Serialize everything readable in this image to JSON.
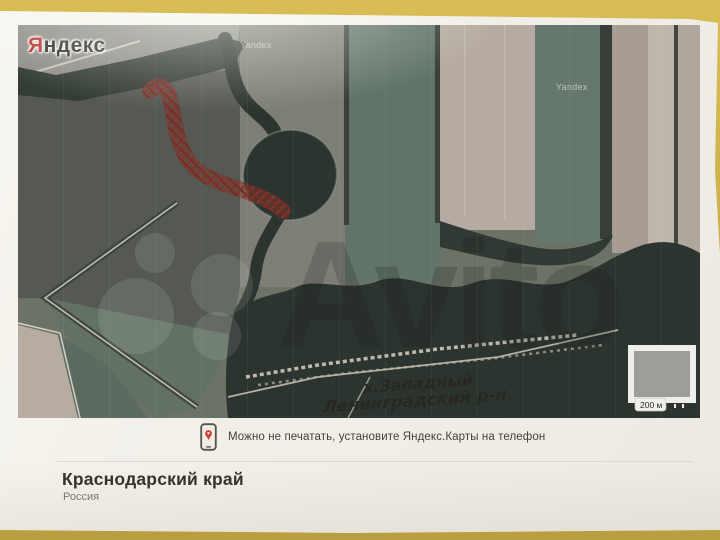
{
  "colors": {
    "surface": "#cdb14b",
    "paper": "#f1efe8",
    "water": "#242f28",
    "field_green": "#5a7264",
    "field_tan": "#b7aa9e",
    "field_gray": "#7b7b72",
    "mark_red": "#8e2b20",
    "yandex_red": "#d8271d",
    "pin_red": "#cf3a2b",
    "divider": "#dbd8d1",
    "text_primary": "#33322d",
    "text_secondary": "#7a7871"
  },
  "map": {
    "provider_logo": {
      "initial": "Я",
      "rest": "ндекс"
    },
    "tile_watermark": "Yandex",
    "site_watermark": "Avito",
    "annotation": {
      "line1": "х.Западный",
      "line2": "Ленинградский р-н"
    },
    "scale_label": "200 м"
  },
  "print_note": {
    "icon": "phone-pin-icon",
    "text": "Можно не печатать, установите Яндекс.Карты на телефон"
  },
  "footer": {
    "title": "Краснодарский край",
    "subtitle": "Россия"
  }
}
